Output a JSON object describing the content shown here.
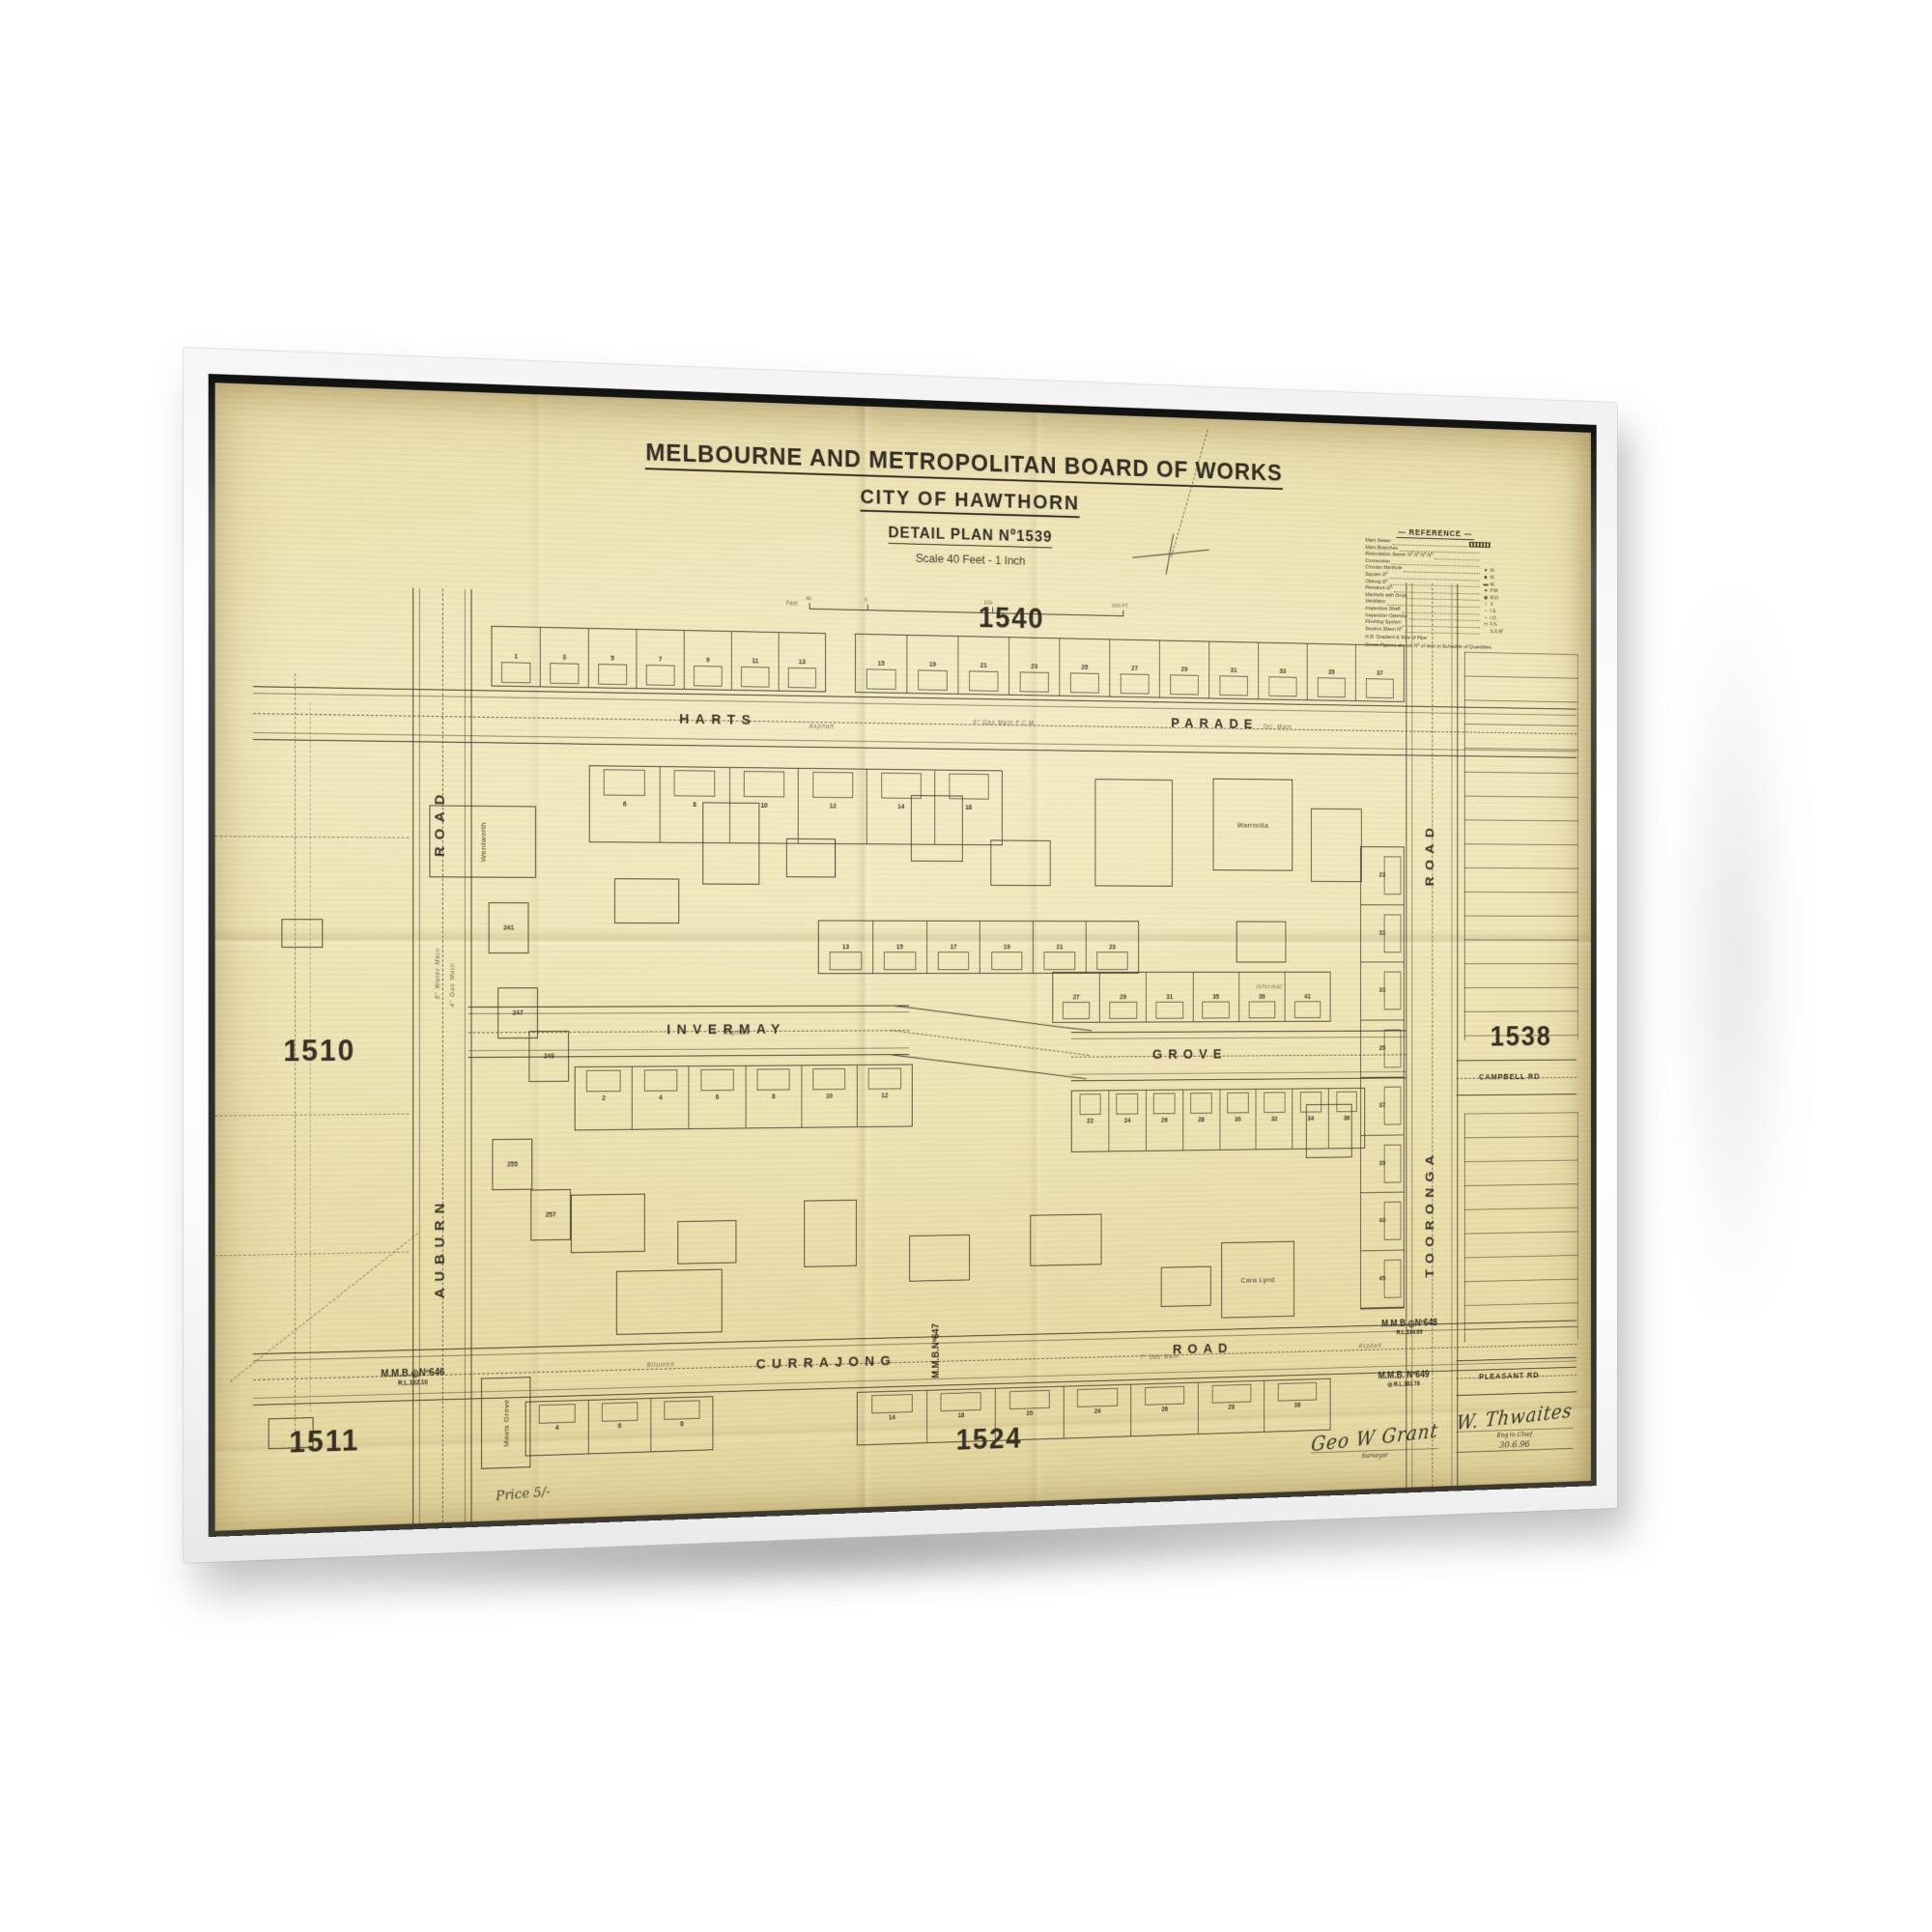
{
  "artwork": {
    "kind": "framed vintage map print",
    "frame_color": "#ffffff",
    "paper_color": "#ece1b0",
    "ink_color": "#453c2f"
  },
  "map": {
    "board": "MELBOURNE AND METROPOLITAN BOARD OF WORKS",
    "city": "CITY OF HAWTHORN",
    "plan_title": "DETAIL PLAN Nº1539",
    "scale_text": "Scale 40 Feet - 1 Inch",
    "scale_bar": {
      "unit_label": "Feet",
      "ticks": [
        "40",
        "0",
        "100",
        "200 FT."
      ]
    },
    "price": "Price 5/-",
    "adjacent_plans": {
      "top": "1540",
      "left": "1510",
      "bottom_left": "1511",
      "right": "1538",
      "bottom": "1524"
    },
    "streets": {
      "harts_first": "HARTS",
      "harts_second": "PARADE",
      "invermay_first": "INVERMAY",
      "invermay_second": "GROVE",
      "currajong_first": "CURRAJONG",
      "currajong_second": "ROAD",
      "auburn_first": "AUBURN",
      "auburn_second": "ROAD",
      "tooronga_first": "TOORONGA",
      "tooronga_second": "ROAD",
      "campbell": "CAMPBELL RD",
      "pleasant": "PLEASANT RD"
    },
    "legend": {
      "title": "REFERENCE",
      "rows": [
        {
          "label": "Main Sewer",
          "symbol": "sewer-line",
          "abbr": ""
        },
        {
          "label": "Main Branches",
          "symbol": "",
          "abbr": ""
        },
        {
          "label": "Reticulation Sewer Nº Nº Nº Nº",
          "symbol": "",
          "abbr": ""
        },
        {
          "label": "Connection",
          "symbol": "",
          "abbr": ""
        },
        {
          "label": "Circular Manhole",
          "symbol": "●",
          "abbr": "M."
        },
        {
          "label": "Square Dº",
          "symbol": "■",
          "abbr": "M."
        },
        {
          "label": "Oblong Dº",
          "symbol": "▬",
          "abbr": "M."
        },
        {
          "label": "Penstock Dº",
          "symbol": "●",
          "abbr": "P.M."
        },
        {
          "label": "Manhole with Drop",
          "symbol": "◉",
          "abbr": "M.D."
        },
        {
          "label": "Ventilator",
          "symbol": "○",
          "abbr": "V."
        },
        {
          "label": "Inspection Shaft",
          "symbol": "▫",
          "abbr": "I.S."
        },
        {
          "label": "Inspection Opening",
          "symbol": "▫",
          "abbr": "I.O."
        },
        {
          "label": "Flushing System",
          "symbol": "▭",
          "abbr": "F.S."
        },
        {
          "label": "Section Sheet Nº",
          "symbol": "",
          "abbr": "S.S.Nº"
        }
      ],
      "note1": "N.B. Gradient & Size of Pipe",
      "note2": "Green Figures denote Nº of Item in Schedule of Quantities."
    },
    "benchmarks": [
      {
        "label": "M.M.B.◎Nº646",
        "rl": "R.L.132.10"
      },
      {
        "label": "M.M.B.Nº647",
        "rl": ""
      },
      {
        "label": "M.M.B.◎Nº648",
        "rl": "R.L.134.69"
      },
      {
        "label": "M.M.B. Nº649",
        "rl": "◎ R.L.182.76"
      }
    ],
    "villas": [
      "Wentworth",
      "Warrinilla",
      "Cara Lynd",
      "Mavis Grove"
    ],
    "house_numbers_auburn": [
      "241",
      "247",
      "249",
      "255",
      "257"
    ],
    "blocks": [
      {
        "id": "harts-north-west",
        "lots": [
          "1",
          "3",
          "5",
          "7",
          "9",
          "11",
          "13"
        ]
      },
      {
        "id": "harts-north-east",
        "lots": [
          "15",
          "19",
          "21",
          "23",
          "25",
          "27",
          "29",
          "31",
          "33",
          "35",
          "37"
        ]
      },
      {
        "id": "harts-south",
        "lots": [
          "6",
          "8",
          "10",
          "12",
          "14",
          "16"
        ]
      },
      {
        "id": "invermay-north",
        "lots": [
          "13",
          "15",
          "17",
          "19",
          "21",
          "23"
        ]
      },
      {
        "id": "grove-north",
        "lots": [
          "27",
          "29",
          "31",
          "35",
          "39",
          "41"
        ]
      },
      {
        "id": "invermay-south",
        "lots": [
          "2",
          "4",
          "6",
          "8",
          "10",
          "12"
        ]
      },
      {
        "id": "grove-south",
        "lots": [
          "22",
          "24",
          "26",
          "28",
          "30",
          "32",
          "34",
          "36"
        ]
      },
      {
        "id": "currajong-south-west",
        "lots": [
          "4",
          "6",
          "8"
        ]
      },
      {
        "id": "currajong-south-east",
        "lots": [
          "14",
          "18",
          "20",
          "24",
          "26",
          "28",
          "38"
        ]
      },
      {
        "id": "tooronga-west",
        "lots": [
          "23",
          "31",
          "33",
          "35",
          "37",
          "39",
          "43",
          "45"
        ]
      }
    ],
    "road_annotations": [
      "Asphalt",
      "6\" Gas Main  F.C.M.",
      "Tel. Main",
      "Bitumen",
      "7' Gas Main",
      "Asphalt",
      "Asphalt",
      "6\" Water Main",
      "4\" Gas Main",
      "Informal"
    ],
    "signatures": {
      "surveyor_sig": "Geo W Grant",
      "surveyor_title": "Surveyor",
      "engineer_sig": "W. Thwaites",
      "engineer_title": "Eng in Chief",
      "date": "30.6.96"
    }
  }
}
